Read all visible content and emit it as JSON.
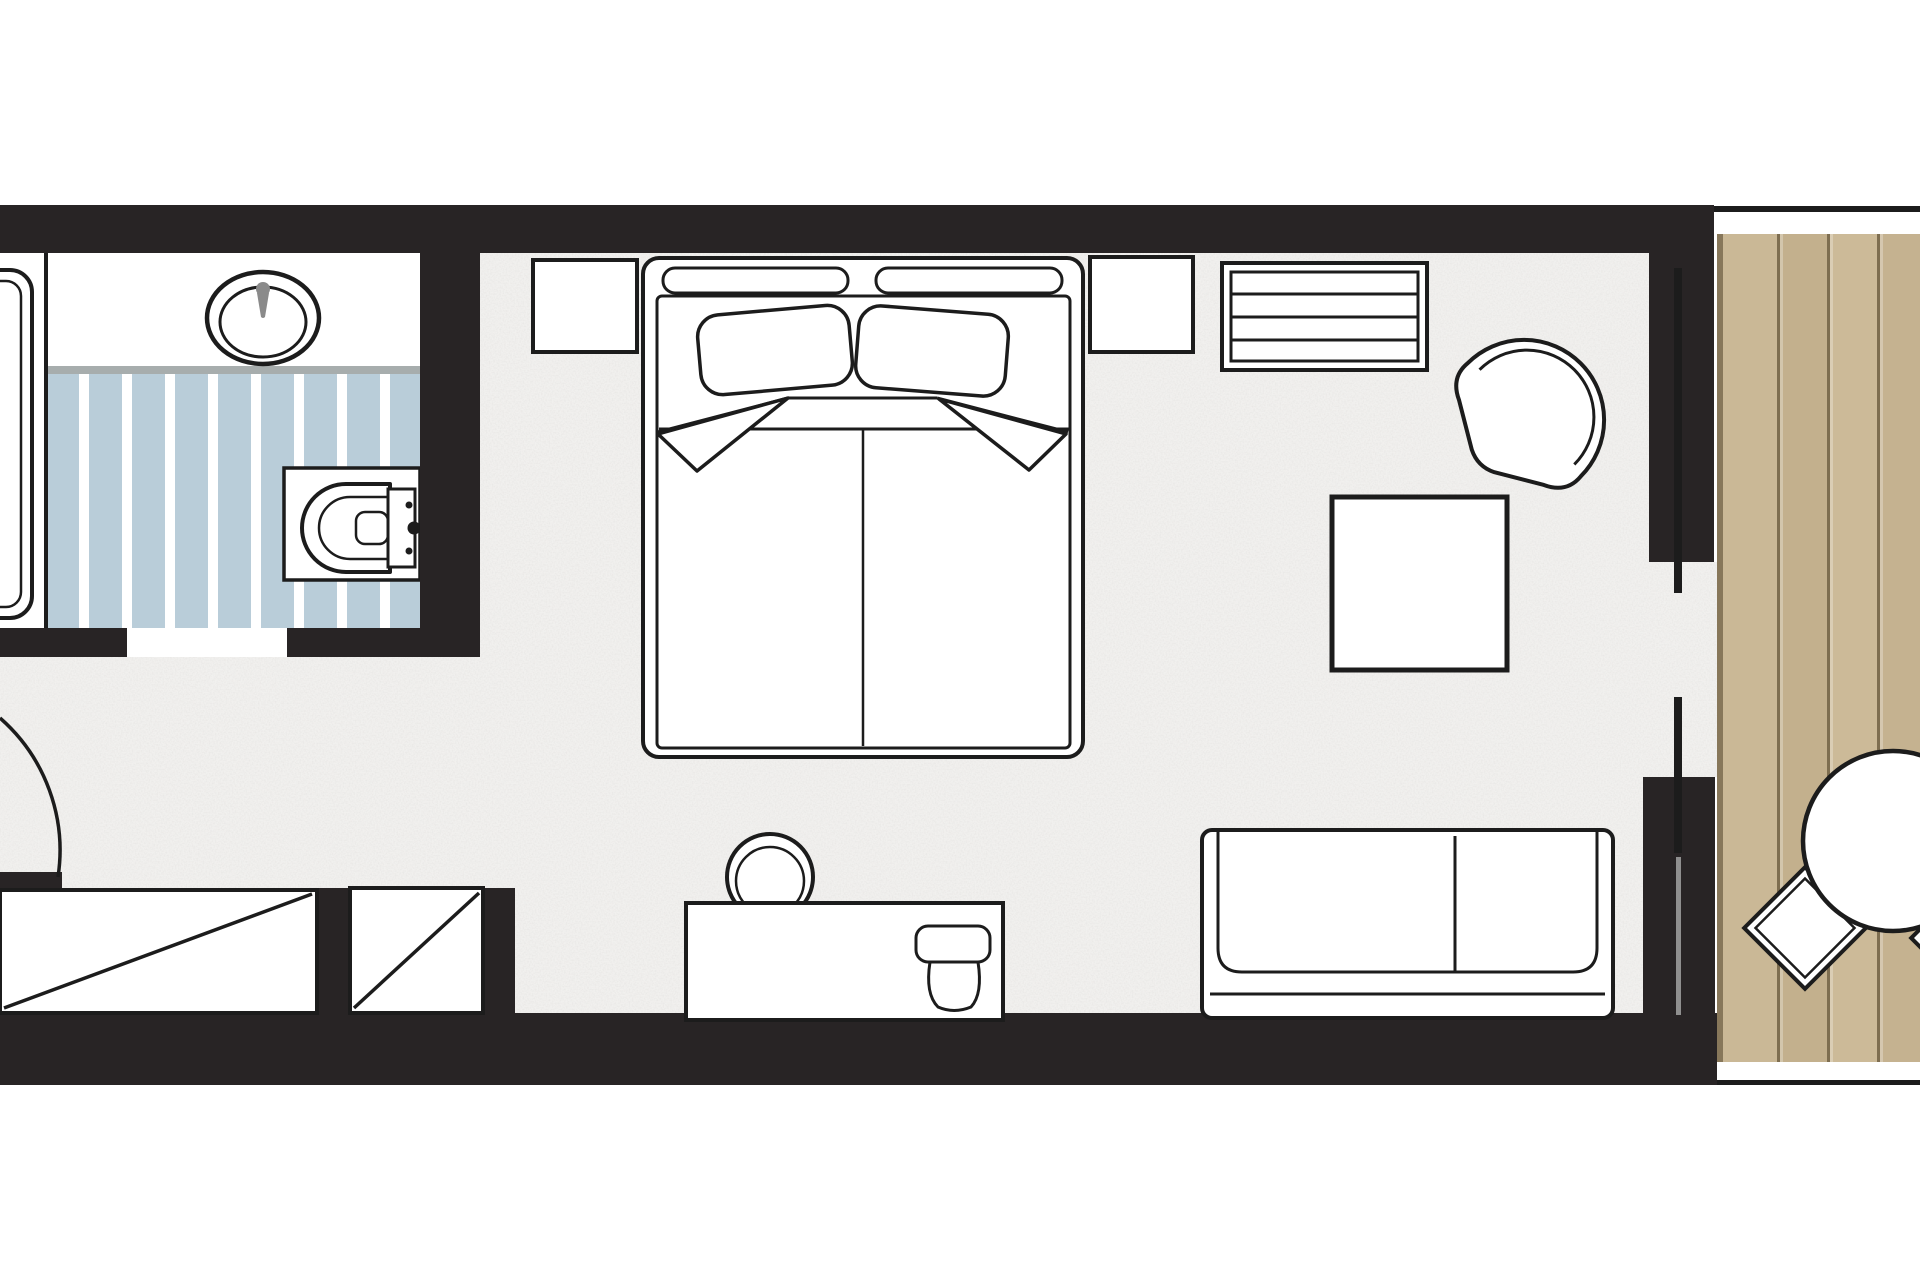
{
  "title": "hotel-room-floor-plan",
  "colors": {
    "wall": "#282425",
    "line": "#1c1c1c",
    "paper": "#ffffff",
    "carpet": "#f1f0ee",
    "carpet-speck": "#c9c7c3",
    "tile-blue": "#b9cdd9",
    "tile-gap": "#ffffff",
    "counter-edge": "#a7adad",
    "metal": "#8a8a8a",
    "glass": "#8f8f8f",
    "deck-edge": "#87775a",
    "deck-a": "#cab896",
    "deck-b": "#c3b08d",
    "deck-c": "#ccba98",
    "deck-d": "#c5b290",
    "deck-groove": "#7e6e50"
  },
  "rooms": {
    "bathroom": "bathroom",
    "bedroom": "bedroom",
    "sitting_area": "sitting area",
    "entry": "entry corridor",
    "balcony": "balcony deck"
  },
  "furniture": {
    "bathtub": "bathtub",
    "vanity_sink": "vanity with oval sink",
    "toilet": "toilet",
    "entry_door": "entry door swing",
    "wardrobe_left": "wardrobe with mirror",
    "wardrobe_right": "wardrobe",
    "double_bed": "double bed with pillows",
    "nightstand_left": "left nightstand",
    "nightstand_right": "right nightstand",
    "desk": "desk",
    "desk_chair": "desk chair",
    "desk_stool": "chair at desk",
    "luggage_bench": "slatted luggage bench",
    "side_table": "square side table",
    "armchair": "corner armchair",
    "sofa": "two-seat sofa",
    "sliding_door": "balcony sliding glass door",
    "balcony_table": "round balcony table",
    "balcony_chair_1": "balcony chair",
    "balcony_chair_2": "balcony chair"
  }
}
